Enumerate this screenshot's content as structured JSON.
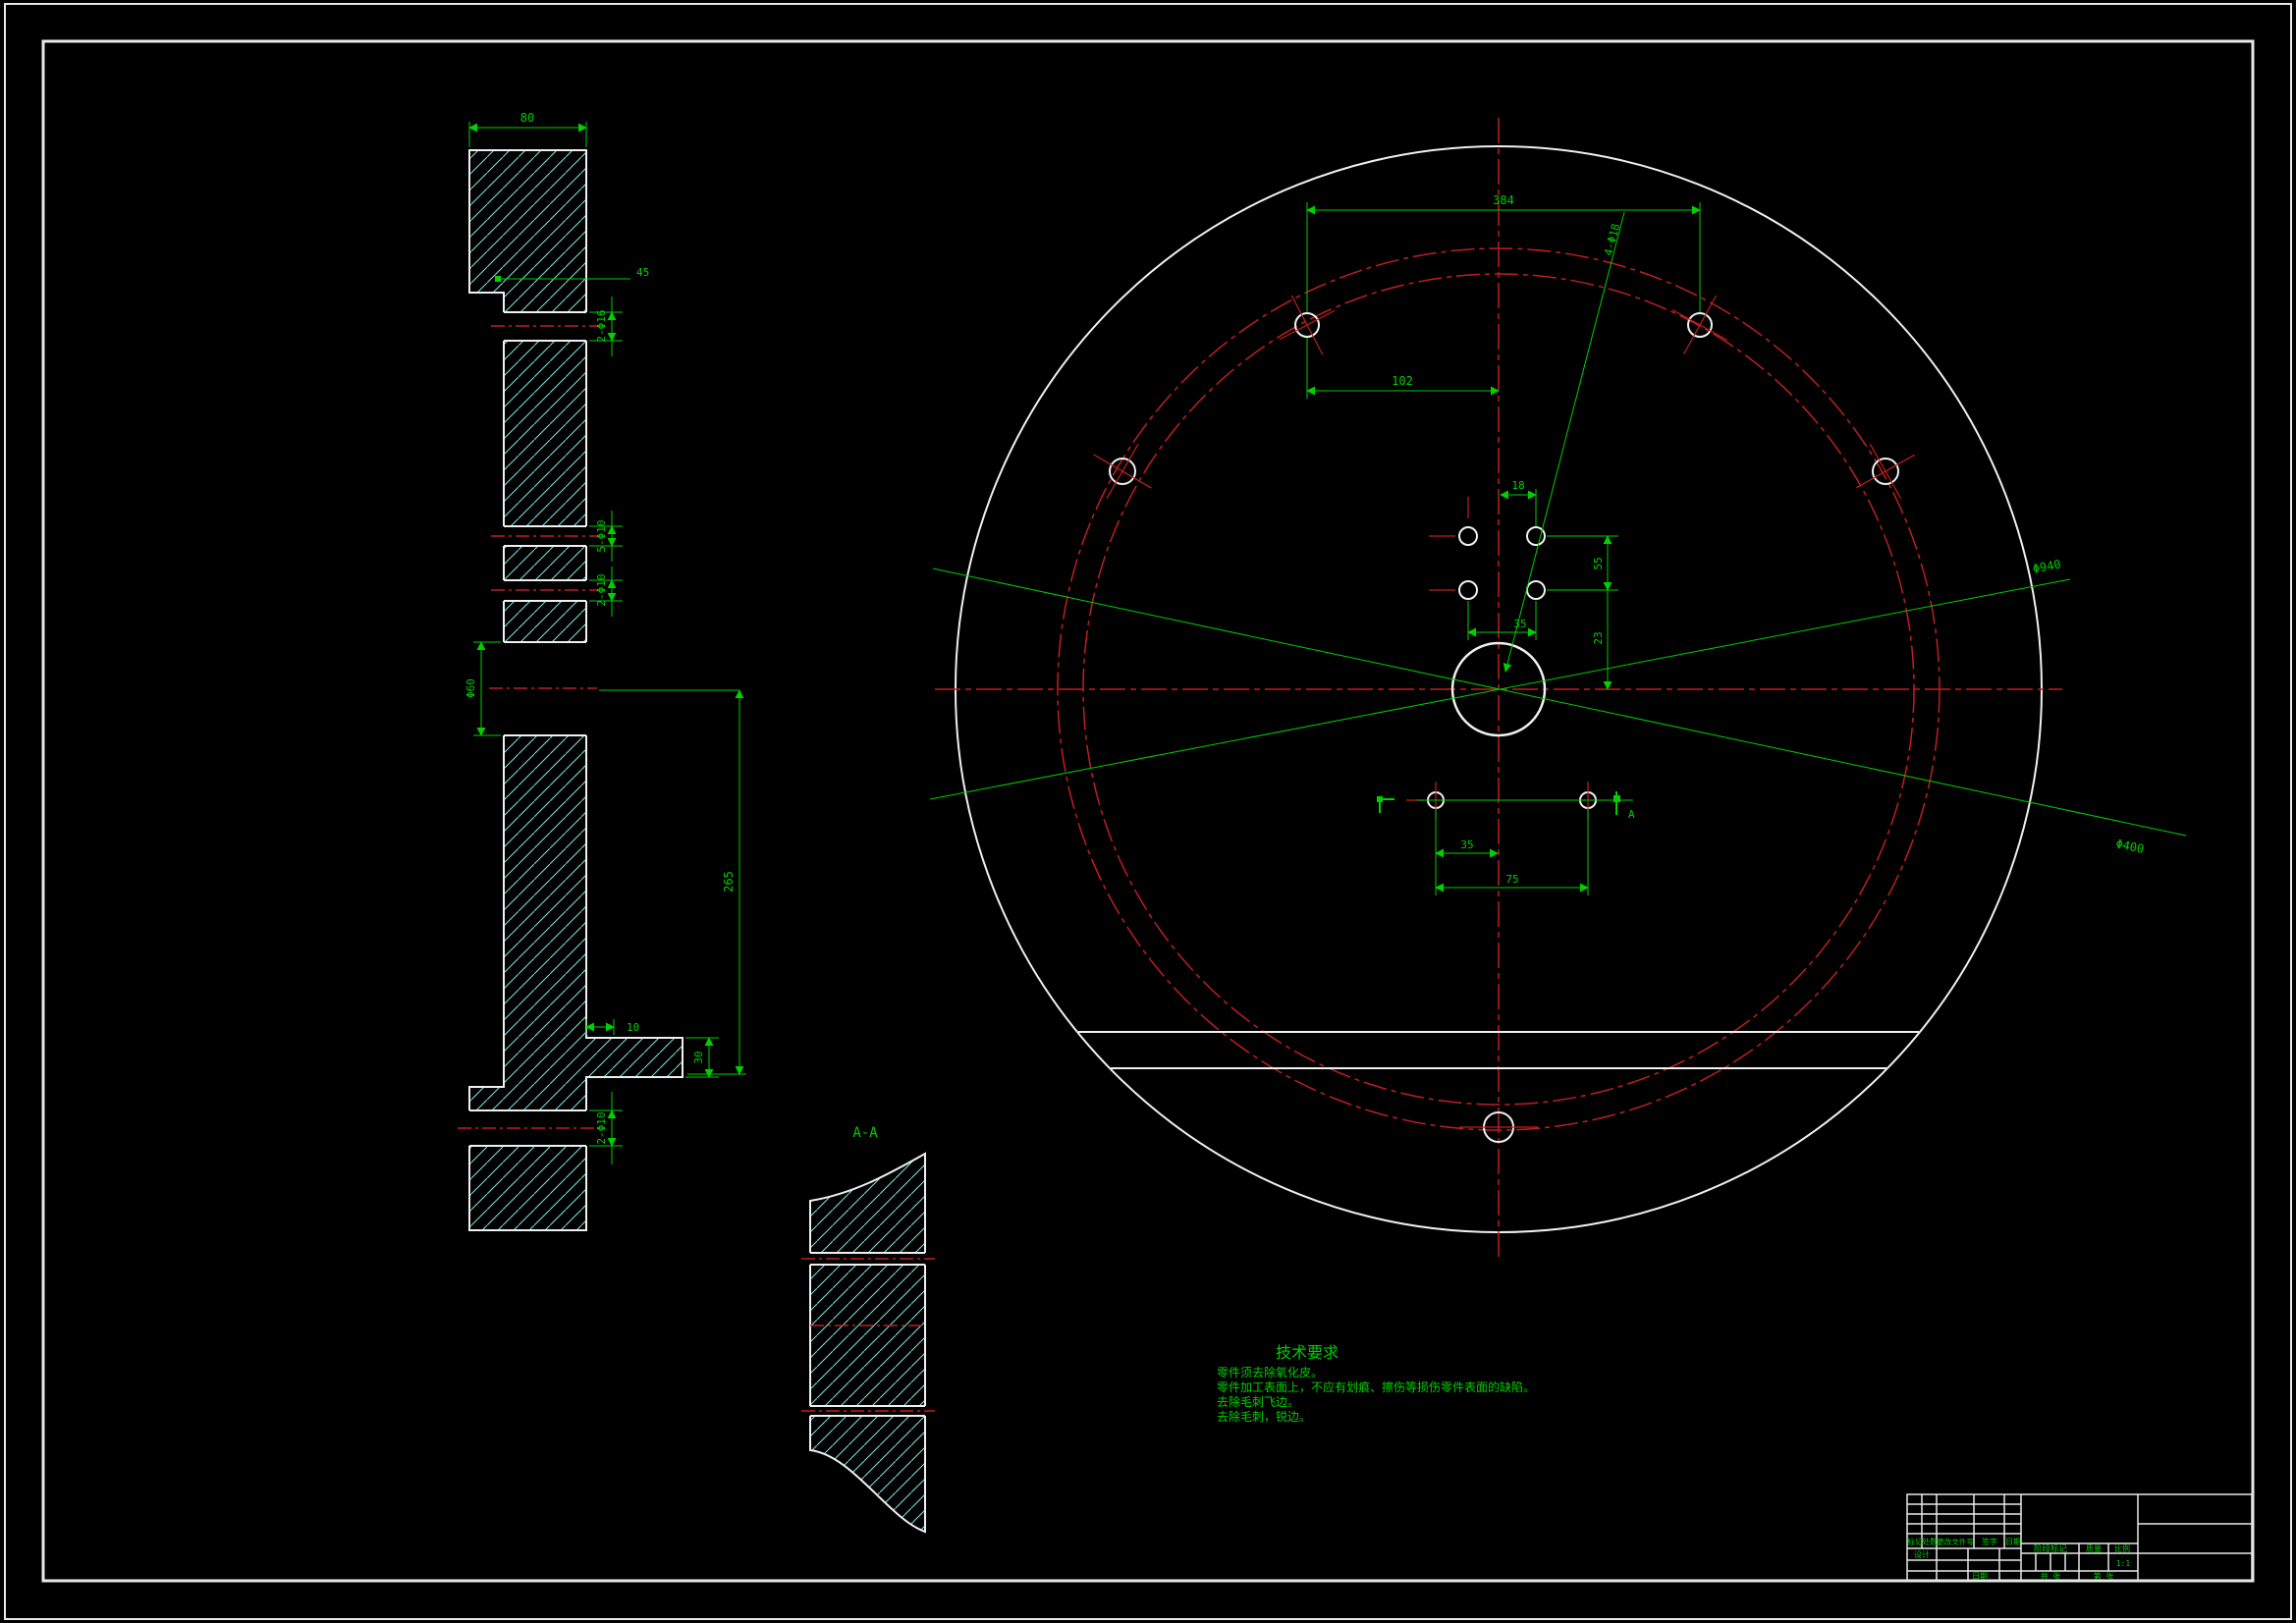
{
  "colors": {
    "background": "#000000",
    "outline": "#f0f0f0",
    "hatch": "#7ee6e6",
    "centerline": "#bf1f1f",
    "dimension": "#00cf00"
  },
  "left_view": {
    "dim_top_width": "80",
    "dim_step": "45",
    "dim_hole_top": "2-Φ16",
    "dim_hole_mid": "5-Φ10",
    "dim_hole_low": "2-Φ10",
    "dim_bore": "Φ60",
    "dim_span": "265",
    "dim_tab_width": "10",
    "dim_tab_height": "30",
    "dim_hole_bottom": "2-Φ10"
  },
  "front_view": {
    "dim_top_span": "384",
    "dim_top_offset": "102",
    "dim_leader_holes": "4-Φ18",
    "dim_pitch_x": "18",
    "dim_span_x": "35",
    "dim_span_y": "55",
    "dim_offset_y": "23",
    "dim_lower_offset": "35",
    "dim_lower_span": "75",
    "dim_bolt_circle": "Φ940",
    "dim_inner_circle": "Φ400",
    "section_mark": "A"
  },
  "section_view": {
    "label": "A-A"
  },
  "tech_requirements": {
    "title": "技术要求",
    "lines": [
      "零件须去除氧化皮。",
      "零件加工表面上，不应有划痕、擦伤等损伤零件表面的缺陷。",
      "去除毛刺飞边。",
      "去除毛刺，锐边。"
    ]
  },
  "title_block": {
    "col_labels": [
      "标记",
      "处数",
      "更改文件号",
      "签字",
      "日期"
    ],
    "designer_label": "设计",
    "date_label": "日期",
    "stage_label": "阶段标记",
    "mass_label": "质量",
    "scale_label": "比例",
    "scale_value": "1:1",
    "sheet_total": "共  张",
    "sheet_no": "第  张"
  }
}
